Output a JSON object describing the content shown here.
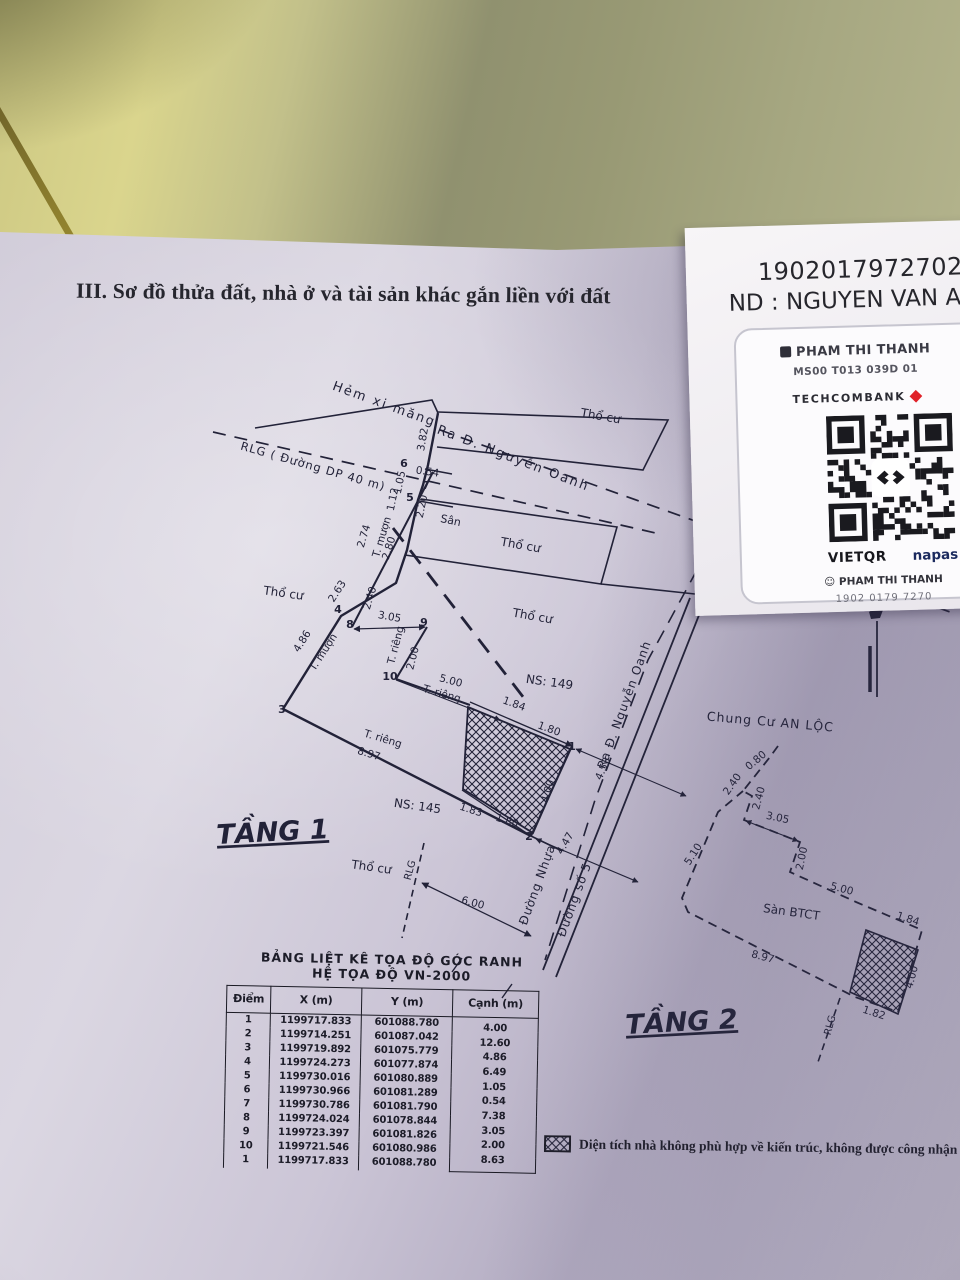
{
  "document": {
    "section_title": "III. Sơ đồ thửa đất, nhà ở và tài sản khác gắn liền với đất"
  },
  "sticker": {
    "account_number": "19020179727023",
    "holder_line": "ND : NGUYEN VAN A",
    "card": {
      "name": "PHAM THI THANH",
      "ms_line": "MS00 T013 039D 01",
      "bank": "TECHCOMBANK",
      "vietqr": "VIETQR",
      "napas": "napas",
      "qr_name": "PHAM THI THANH",
      "qr_phone": "1902 0179 7270"
    }
  },
  "coords_table": {
    "title1": "BẢNG LIỆT KÊ TỌA ĐỘ GÓC RANH",
    "title2": "HỆ TỌA ĐỘ VN-2000",
    "headers": [
      "Điểm",
      "X (m)",
      "Y (m)",
      "Cạnh (m)"
    ],
    "points": [
      [
        "1",
        "1199717.833",
        "601088.780"
      ],
      [
        "2",
        "1199714.251",
        "601087.042"
      ],
      [
        "3",
        "1199719.892",
        "601075.779"
      ],
      [
        "4",
        "1199724.273",
        "601077.874"
      ],
      [
        "5",
        "1199730.016",
        "601080.889"
      ],
      [
        "6",
        "1199730.966",
        "601081.289"
      ],
      [
        "7",
        "1199730.786",
        "601081.790"
      ],
      [
        "8",
        "1199724.024",
        "601078.844"
      ],
      [
        "9",
        "1199723.397",
        "601081.826"
      ],
      [
        "10",
        "1199721.546",
        "601080.986"
      ],
      [
        "1",
        "1199717.833",
        "601088.780"
      ]
    ],
    "edges": [
      "4.00",
      "12.60",
      "4.86",
      "6.49",
      "1.05",
      "0.54",
      "7.38",
      "3.05",
      "2.00",
      "8.63"
    ]
  },
  "legend": {
    "note": "Diện tích nhà không phù hợp về kiến trúc, không được công nhận"
  },
  "diagram": {
    "ink": "#222238",
    "labels": [
      {
        "t": "Hẻm xi măng",
        "x": 383,
        "y": 408,
        "r": 20,
        "s": 13,
        "ls": 2
      },
      {
        "t": "Ra Đ. Nguyễn Oanh",
        "x": 512,
        "y": 462,
        "r": 21,
        "s": 13,
        "ls": 2
      },
      {
        "t": "Thổ cư",
        "x": 600,
        "y": 420,
        "r": 10,
        "s": 12
      },
      {
        "t": "RLG ( Đường DP 40 m)",
        "x": 312,
        "y": 470,
        "r": 16,
        "s": 11.5,
        "ls": 1
      },
      {
        "t": "Thổ cư",
        "x": 283,
        "y": 597,
        "r": 8,
        "s": 12
      },
      {
        "t": "Thổ cư",
        "x": 520,
        "y": 549,
        "r": 10,
        "s": 12
      },
      {
        "t": "Thổ cư",
        "x": 532,
        "y": 620,
        "r": 10,
        "s": 12
      },
      {
        "t": "Thổ cư",
        "x": 371,
        "y": 871,
        "r": 8,
        "s": 12
      },
      {
        "t": "NS: 149",
        "x": 549,
        "y": 686,
        "r": 8,
        "s": 12
      },
      {
        "t": "NS: 145",
        "x": 417,
        "y": 810,
        "r": 8,
        "s": 12
      },
      {
        "t": "Sân",
        "x": 450,
        "y": 524,
        "r": 12,
        "s": 11
      },
      {
        "t": "Chung Cư AN LỘC",
        "x": 770,
        "y": 726,
        "r": 5,
        "s": 12.5,
        "ls": 1
      },
      {
        "t": "Sàn BTCT",
        "x": 791,
        "y": 916,
        "r": 8,
        "s": 12
      },
      {
        "t": "TẦNG 1",
        "x": 273,
        "y": 841,
        "r": -3,
        "s": 27,
        "b": 1,
        "u": 1
      },
      {
        "t": "TẦNG 2",
        "x": 682,
        "y": 1031,
        "r": -3,
        "s": 27,
        "b": 1,
        "u": 1
      },
      {
        "t": "Đường Nhựa",
        "x": 541,
        "y": 886,
        "r": -70,
        "s": 12,
        "ls": 1
      },
      {
        "t": "Đường số 5",
        "x": 578,
        "y": 901,
        "r": -70,
        "s": 12,
        "ls": 1
      },
      {
        "t": "Ra Đ. Nguyễn Oanh",
        "x": 628,
        "y": 706,
        "r": -70,
        "s": 12,
        "ls": 1
      },
      {
        "t": "RLG",
        "x": 413,
        "y": 871,
        "r": -75,
        "s": 10
      },
      {
        "t": "RLG",
        "x": 833,
        "y": 1026,
        "r": -75,
        "s": 10
      },
      {
        "t": "T. mượn",
        "x": 385,
        "y": 538,
        "r": -73,
        "s": 10.5
      },
      {
        "t": "T. mượn",
        "x": 326,
        "y": 654,
        "r": -57,
        "s": 10.5
      },
      {
        "t": "T. riêng",
        "x": 399,
        "y": 646,
        "r": -75,
        "s": 10.5
      },
      {
        "t": "T. riêng",
        "x": 441,
        "y": 697,
        "r": 16,
        "s": 10.5
      },
      {
        "t": "T. riêng",
        "x": 382,
        "y": 742,
        "r": 17,
        "s": 10.5
      },
      {
        "t": "3.82",
        "x": 426,
        "y": 440,
        "r": -80,
        "s": 10.5
      },
      {
        "t": "0.54",
        "x": 427,
        "y": 475,
        "r": 8,
        "s": 10.5
      },
      {
        "t": "1.05",
        "x": 403,
        "y": 483,
        "r": -78,
        "s": 10.5
      },
      {
        "t": "1.12",
        "x": 396,
        "y": 500,
        "r": -78,
        "s": 10.5
      },
      {
        "t": "2.20",
        "x": 425,
        "y": 507,
        "r": -78,
        "s": 10.5
      },
      {
        "t": "2.74",
        "x": 367,
        "y": 537,
        "r": -73,
        "s": 10.5
      },
      {
        "t": "2.80",
        "x": 392,
        "y": 549,
        "r": -73,
        "s": 10.5
      },
      {
        "t": "2.40",
        "x": 373,
        "y": 599,
        "r": -73,
        "s": 10.5
      },
      {
        "t": "2.63",
        "x": 340,
        "y": 593,
        "r": -57,
        "s": 10.5
      },
      {
        "t": "4.86",
        "x": 305,
        "y": 643,
        "r": -58,
        "s": 10.5
      },
      {
        "t": "3.05",
        "x": 389,
        "y": 620,
        "r": 10,
        "s": 10.5
      },
      {
        "t": "2.00",
        "x": 416,
        "y": 659,
        "r": -76,
        "s": 10.5
      },
      {
        "t": "5.00",
        "x": 450,
        "y": 684,
        "r": 15,
        "s": 10.5
      },
      {
        "t": "8.97",
        "x": 368,
        "y": 757,
        "r": 17,
        "s": 10.5
      },
      {
        "t": "1.84",
        "x": 513,
        "y": 707,
        "r": 20,
        "s": 10.5
      },
      {
        "t": "1.80",
        "x": 548,
        "y": 732,
        "r": 20,
        "s": 10.5
      },
      {
        "t": "4.00",
        "x": 551,
        "y": 792,
        "r": -74,
        "s": 10.5
      },
      {
        "t": "1.83",
        "x": 470,
        "y": 813,
        "r": 18,
        "s": 10.5
      },
      {
        "t": "1.80",
        "x": 506,
        "y": 824,
        "r": 18,
        "s": 10.5
      },
      {
        "t": "4.53",
        "x": 606,
        "y": 770,
        "r": -66,
        "s": 10.5
      },
      {
        "t": "4.47",
        "x": 568,
        "y": 845,
        "r": -60,
        "s": 10.5
      },
      {
        "t": "6.00",
        "x": 472,
        "y": 906,
        "r": 15,
        "s": 10.5
      },
      {
        "t": "0.80",
        "x": 758,
        "y": 763,
        "r": -40,
        "s": 10.5
      },
      {
        "t": "2.40",
        "x": 735,
        "y": 786,
        "r": -55,
        "s": 10.5
      },
      {
        "t": "2.40",
        "x": 762,
        "y": 799,
        "r": -75,
        "s": 10.5
      },
      {
        "t": "3.05",
        "x": 777,
        "y": 821,
        "r": 12,
        "s": 10.5
      },
      {
        "t": "5.10",
        "x": 696,
        "y": 856,
        "r": -57,
        "s": 10.5
      },
      {
        "t": "2.00",
        "x": 805,
        "y": 859,
        "r": -78,
        "s": 10.5
      },
      {
        "t": "5.00",
        "x": 841,
        "y": 892,
        "r": 15,
        "s": 10.5
      },
      {
        "t": "8.97",
        "x": 762,
        "y": 960,
        "r": 15,
        "s": 10.5
      },
      {
        "t": "1.84",
        "x": 907,
        "y": 922,
        "r": 18,
        "s": 10.5
      },
      {
        "t": "4.00",
        "x": 915,
        "y": 978,
        "r": -75,
        "s": 10.5
      },
      {
        "t": "1.82",
        "x": 873,
        "y": 1016,
        "r": 18,
        "s": 10.5
      },
      {
        "t": "6",
        "x": 404,
        "y": 467,
        "r": 0,
        "s": 11,
        "b": 1
      },
      {
        "t": "7",
        "x": 426,
        "y": 489,
        "r": 0,
        "s": 11,
        "b": 1
      },
      {
        "t": "5",
        "x": 410,
        "y": 501,
        "r": 0,
        "s": 11,
        "b": 1
      },
      {
        "t": "4",
        "x": 338,
        "y": 613,
        "r": 0,
        "s": 11,
        "b": 1
      },
      {
        "t": "8",
        "x": 350,
        "y": 628,
        "r": 0,
        "s": 11,
        "b": 1
      },
      {
        "t": "9",
        "x": 424,
        "y": 626,
        "r": 0,
        "s": 11,
        "b": 1
      },
      {
        "t": "10",
        "x": 390,
        "y": 680,
        "r": 0,
        "s": 11,
        "b": 1
      },
      {
        "t": "3",
        "x": 282,
        "y": 713,
        "r": 0,
        "s": 11,
        "b": 1
      },
      {
        "t": "1",
        "x": 572,
        "y": 750,
        "r": 0,
        "s": 11,
        "b": 1
      },
      {
        "t": "2",
        "x": 529,
        "y": 840,
        "r": 0,
        "s": 11,
        "b": 1
      }
    ]
  }
}
